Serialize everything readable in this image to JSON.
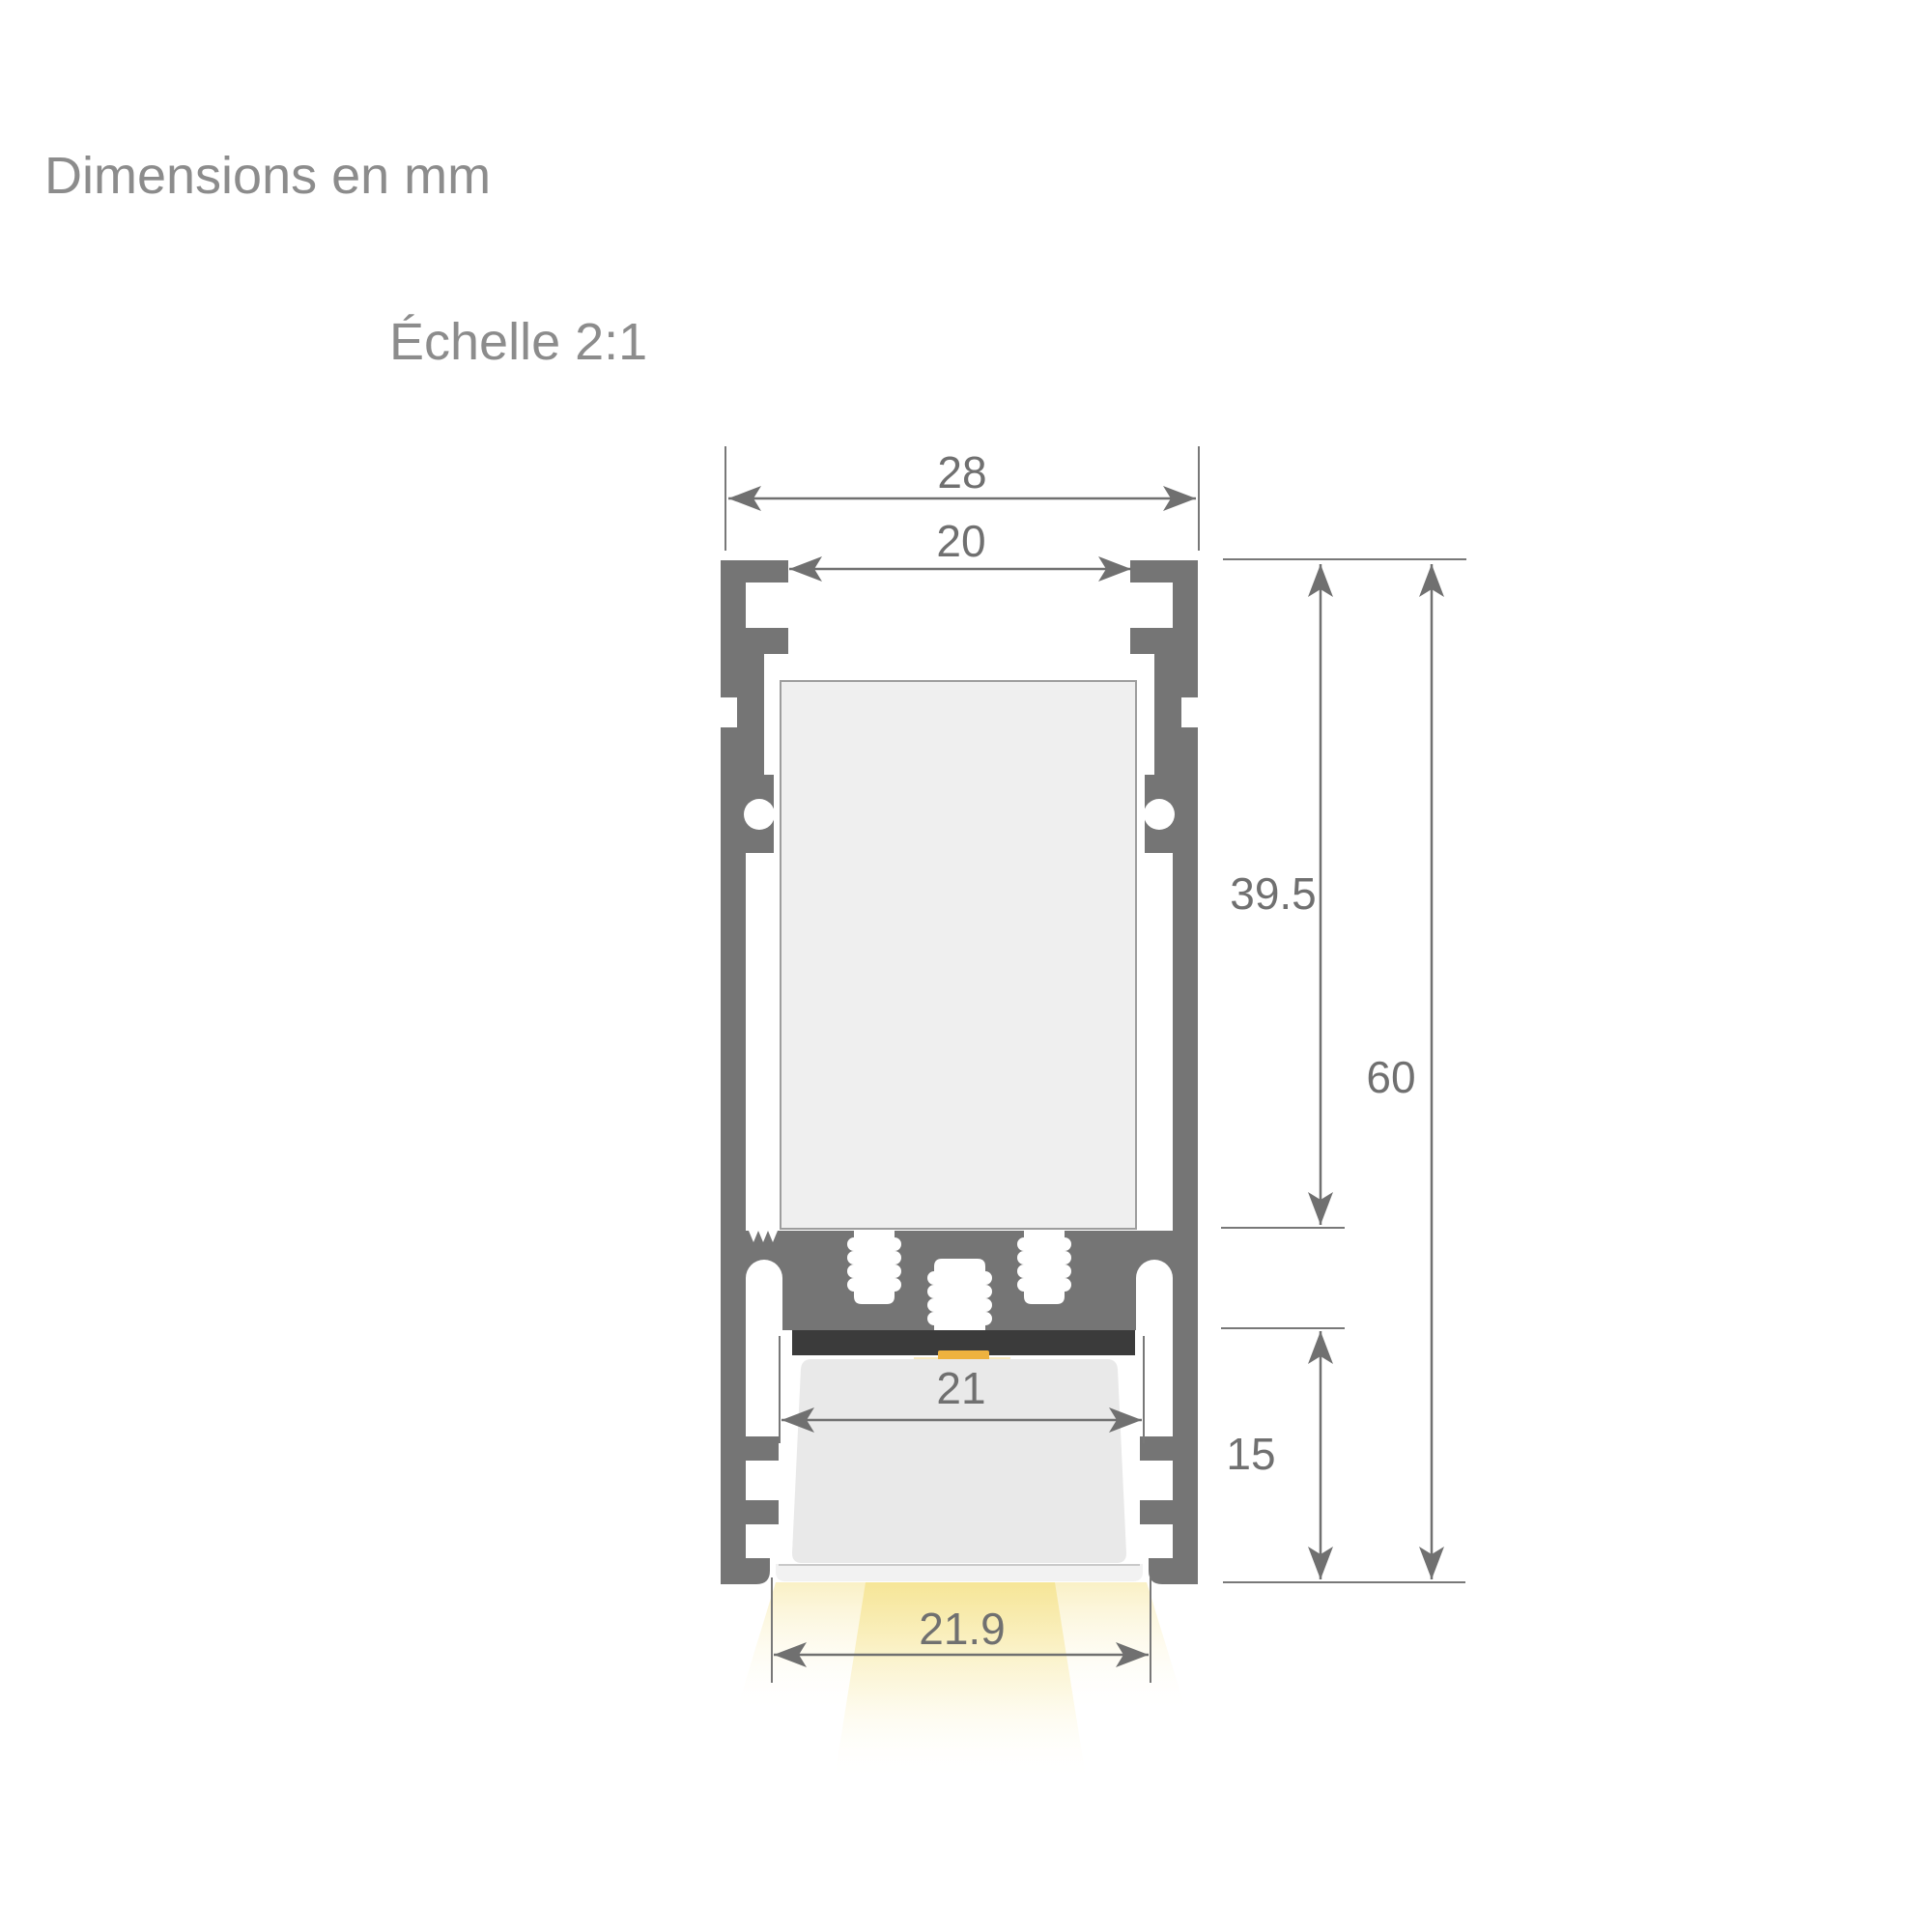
{
  "header": {
    "title": "Dimensions en mm",
    "scale_label": "Échelle 2:1"
  },
  "drawing": {
    "type": "technical-cross-section",
    "subject": "LED aluminium profile cross-section with downward light beam",
    "units": "mm",
    "dims": {
      "outer_width": "28",
      "inner_width": "20",
      "body_height": "39.5",
      "total_height": "60",
      "lower_height": "15",
      "diffuser_slot_width": "21",
      "light_opening_width": "21.9"
    },
    "colors": {
      "aluminium": "#757575",
      "dimension_lines": "#707070",
      "dimension_text": "#707070",
      "titles": "#8c8c8c",
      "cavity_fill": "#efefef",
      "cavity_border": "#9d9d9d",
      "pcb": "#3b3b3b",
      "led": "#eeb23f",
      "diffuser": "#e9e9e9",
      "diffuser_lip": "#f2f2f2",
      "light_beam": "#f7e798"
    }
  }
}
